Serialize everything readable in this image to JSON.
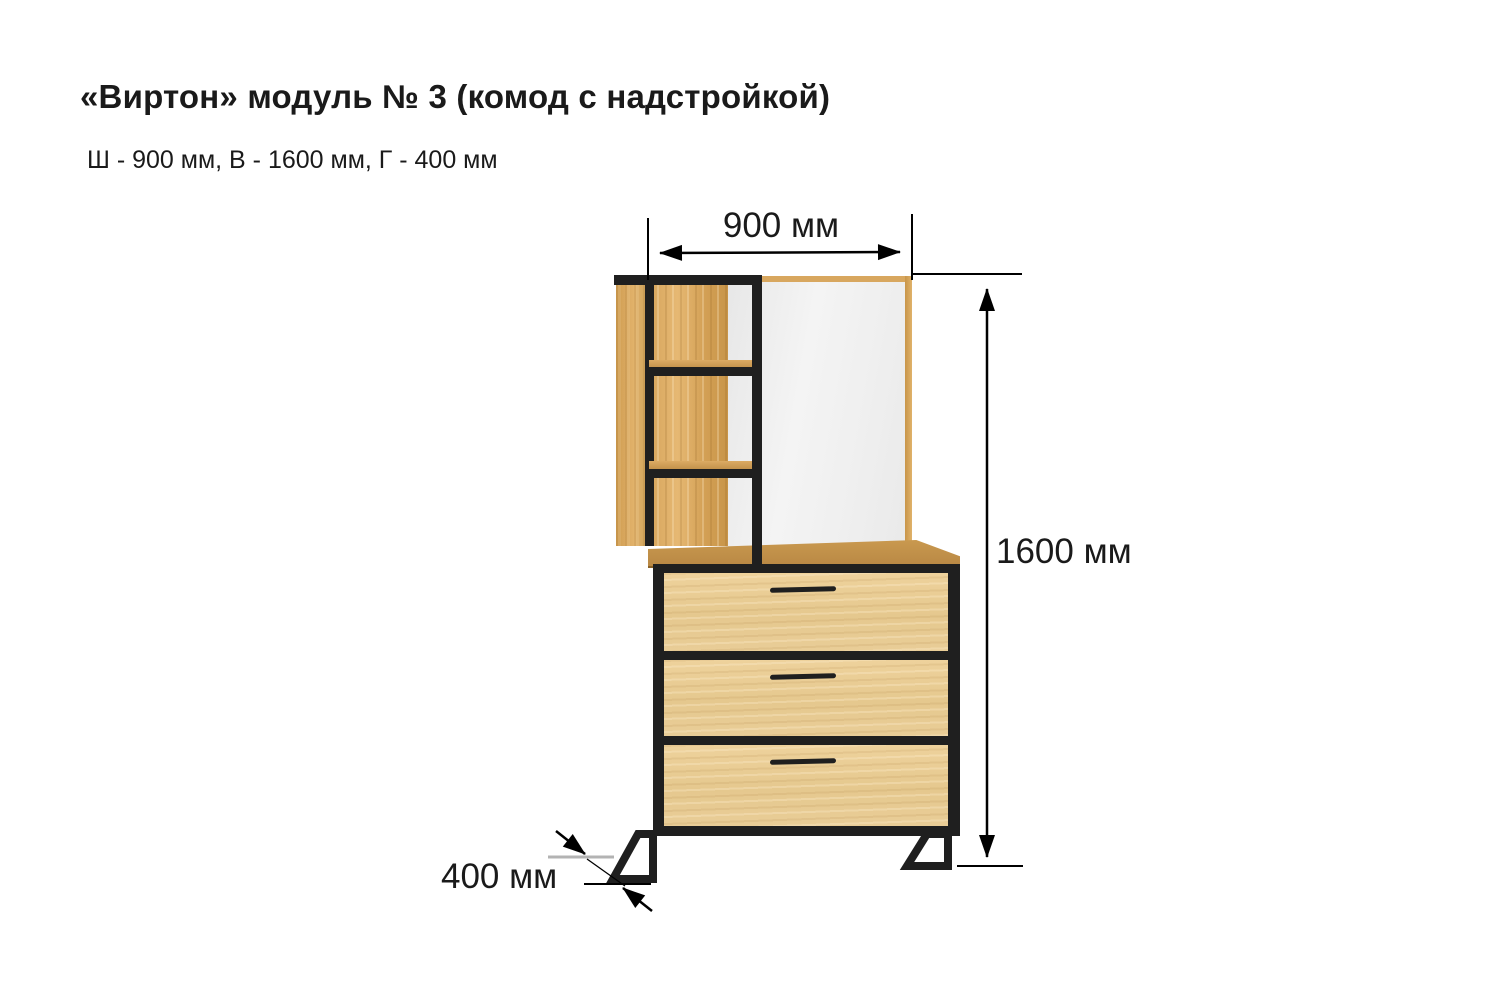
{
  "header": {
    "title": "«Виртон» модуль № 3 (комод с надстройкой)",
    "subtitle": "Ш - 900 мм, В - 1600 мм, Г - 400 мм"
  },
  "dimensions": {
    "width_label": "900 мм",
    "height_label": "1600 мм",
    "depth_label": "400 мм"
  },
  "furniture": {
    "drawer_count": "3",
    "shelf_count": "3"
  },
  "colors": {
    "page_bg": "#ffffff",
    "text_black": "#1a1a1a",
    "frame_black": "#1f1f1f",
    "wood_medium": "#d8a75f",
    "wood_light": "#e9cd97",
    "wood_top": "#c9994f",
    "mirror": "#efefef",
    "dimension_line": "#000000",
    "depth_gray_line": "#b3b3b3"
  }
}
